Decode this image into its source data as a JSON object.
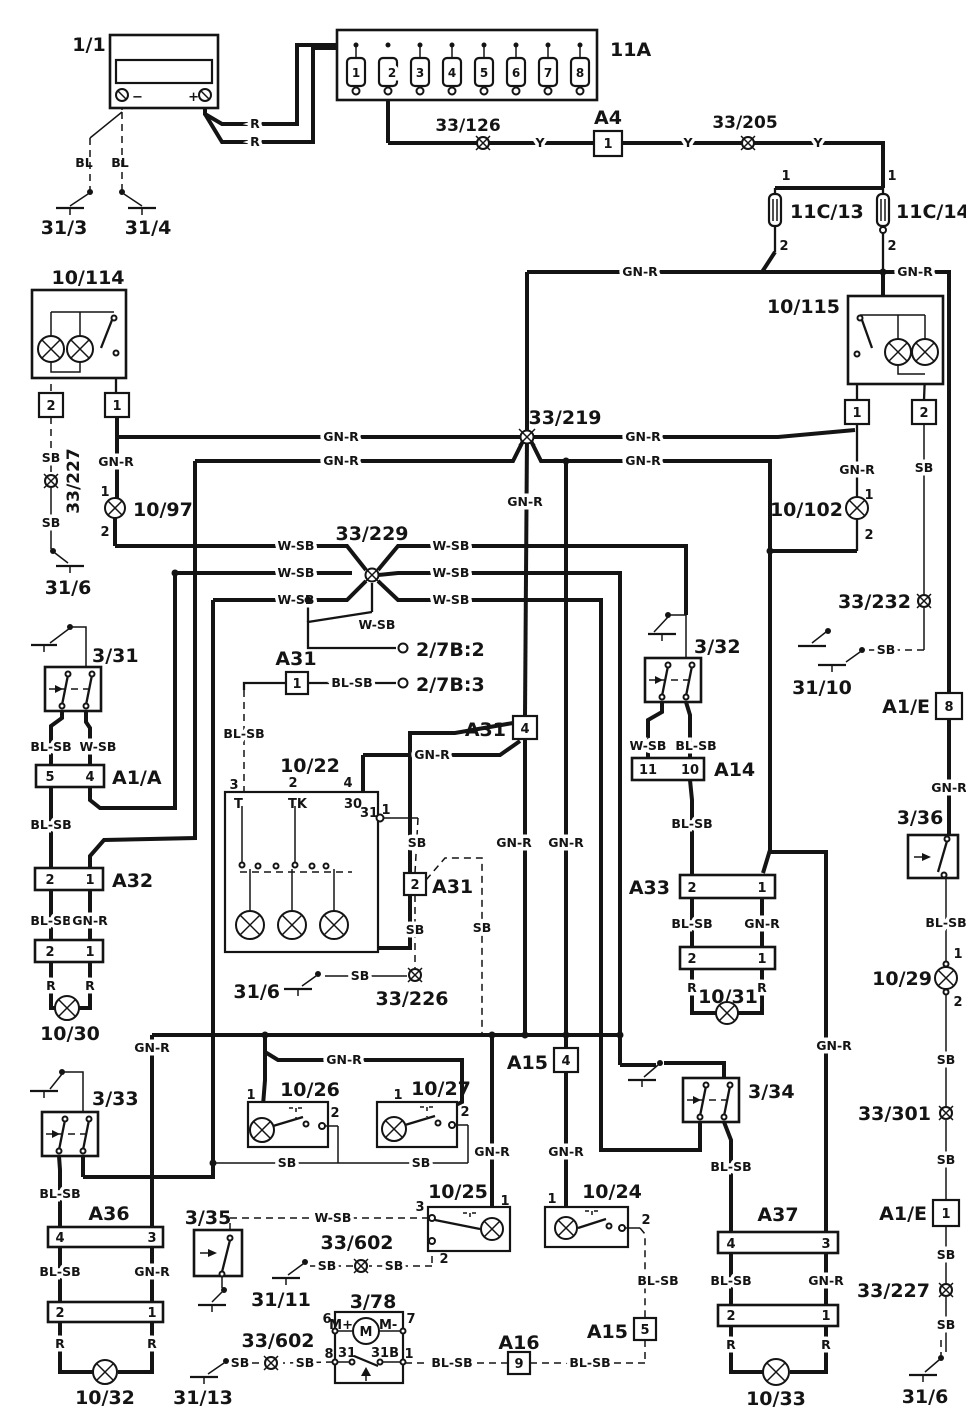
{
  "colors": {
    "ink": "#141414",
    "paper": "#ffffff"
  },
  "c": {
    "battery": "1/1",
    "fusebox": "11A",
    "a4": "A4",
    "c13": "11C/13",
    "c14": "11C/14",
    "l114": "10/114",
    "l115": "10/115",
    "l97": "10/97",
    "l102": "10/102",
    "l22": "10/22",
    "l30": "10/30",
    "l31": "10/31",
    "l32": "10/32",
    "l33": "10/33",
    "l29": "10/29",
    "l24": "10/24",
    "l25": "10/25",
    "l26": "10/26",
    "l27": "10/27",
    "s31": "3/31",
    "s32": "3/32",
    "s33": "3/33",
    "s34": "3/34",
    "s35": "3/35",
    "s36": "3/36",
    "m78": "3/78",
    "a1a": "A1/A",
    "a1e": "A1/E",
    "a31": "A31",
    "a32": "A32",
    "a33": "A33",
    "a14": "A14",
    "a36": "A36",
    "a37": "A37",
    "a15": "A15",
    "a16": "A16"
  },
  "w": {
    "r": "R",
    "y": "Y",
    "bl": "BL",
    "sb": "SB",
    "gnr": "GN-R",
    "wsb": "W-SB",
    "blsb": "BL-SB",
    "m": "M",
    "mplus": "M+",
    "mminus": "M-"
  },
  "p": {
    "p1": "1",
    "p2": "2",
    "p3": "3",
    "p4": "4",
    "p5": "5",
    "p6": "6",
    "p7": "7",
    "p8": "8",
    "p9": "9",
    "p10": "10",
    "p11": "11",
    "p30": "30",
    "p31": "31",
    "p31b": "31B",
    "t": "T",
    "tk": "TK"
  },
  "g": {
    "g3": "31/3",
    "g4": "31/4",
    "g6": "31/6",
    "g10": "31/10",
    "g11": "31/11",
    "g13": "31/13"
  },
  "s": {
    "s126": "33/126",
    "s205": "33/205",
    "s219": "33/219",
    "s226": "33/226",
    "s227": "33/227",
    "s229": "33/229",
    "s232": "33/232",
    "s301": "33/301",
    "s602": "33/602",
    "t72": "2/7B:2",
    "t73": "2/7B:3"
  }
}
